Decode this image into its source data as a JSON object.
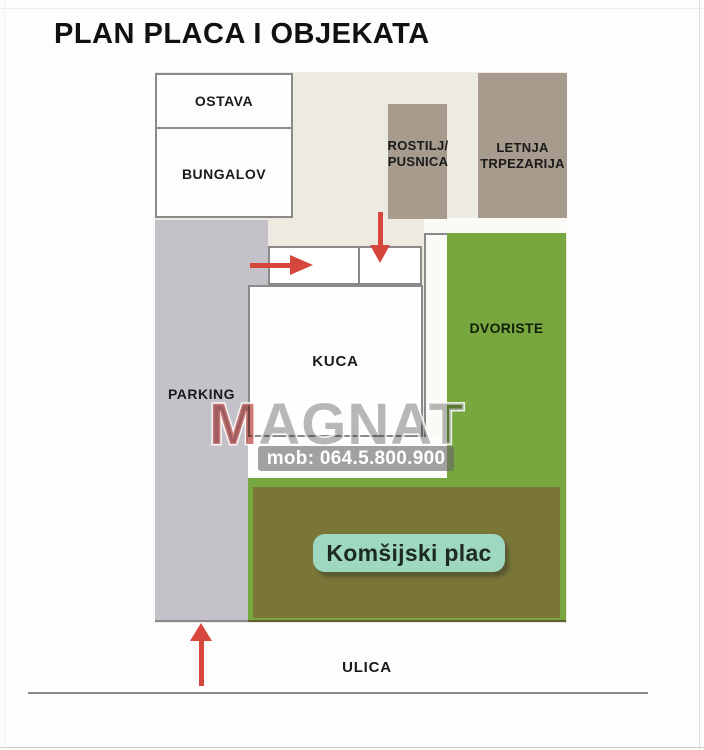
{
  "title": "PLAN PLACA I OBJEKATA",
  "plan": {
    "rooms": {
      "ostava": "OSTAVA",
      "bungalov": "BUNGALOV",
      "rostilj": [
        "ROSTILJ/",
        "PUSNICA"
      ],
      "letnja": [
        "LETNJA",
        "TRPEZARIJA"
      ],
      "parking": "PARKING",
      "kuca": "KUCA",
      "dvoriste": "DVORISTE"
    },
    "neighbor_label": "Komšijski plac",
    "street_label": "ULICA"
  },
  "watermark": {
    "brand_initial": "M",
    "brand_rest": "AGNAT",
    "phone": "mob: 064.5.800.900"
  },
  "colors": {
    "plan_background": "#edeae2",
    "parking_gray": "#c4c1c9",
    "building_taupe": "#a69b8c",
    "yard_green": "#78a740",
    "neighbor_olive": "#797638",
    "label_mint": "#9fd8c1",
    "arrow_red": "#d6463c",
    "watermark_red": "#b02823",
    "watermark_gray": "#7d7d7d"
  },
  "icons": {
    "arrow_up": "red-up-arrow",
    "arrow_right": "red-right-arrow",
    "arrow_down": "red-down-arrow"
  }
}
